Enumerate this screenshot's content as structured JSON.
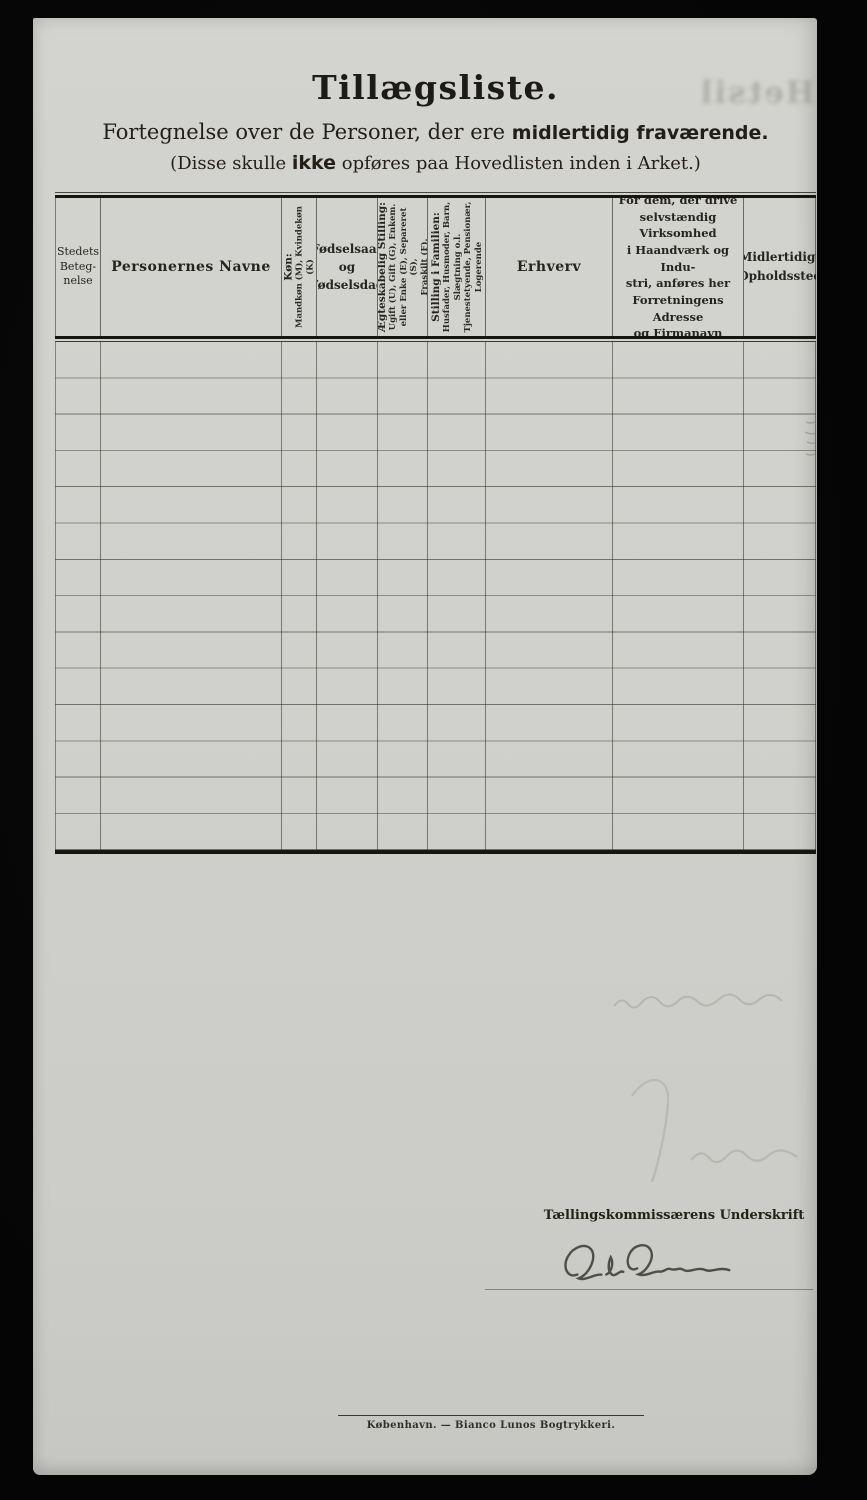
{
  "page": {
    "title": "Tillægsliste.",
    "subtitle_prefix": "Fortegnelse over de Personer, der ere ",
    "subtitle_bold": "midlertidig fraværende.",
    "note_prefix": "(Disse skulle ",
    "note_bold": "ikke",
    "note_suffix": " opføres paa Hovedlisten inden i Arket.)",
    "ghost_text": "Hetsil"
  },
  "table": {
    "columns": [
      {
        "label": "Stedets\nBeteg-\nnelse"
      },
      {
        "label": "Personernes Navne"
      },
      {
        "heading": "Køn:",
        "detail": "Mandkøn (M), Kvindekøn (K)"
      },
      {
        "label": "Fødselsaar\nog\nFødselsdag"
      },
      {
        "heading": "Ægteskabelig Stilling:",
        "detail": "Ugift (U), Gift (G), Enkem.\neller Enke (E), Separeret (S),\nFraskilt (F)."
      },
      {
        "heading": "Stilling i Familien:",
        "detail": "Husfader, Husmoder, Barn,\nSlægtning o.l.\nTjenestetyende, Pensionær,\nLogerende"
      },
      {
        "label": "Erhverv"
      },
      {
        "label": "For dem, der drive\nselvstændig Virksomhed\ni Haandværk og Indu-\nstri, anføres her\nForretningens Adresse\nog Firmanavn"
      },
      {
        "label": "Midlertidigt\nOpholdssted"
      }
    ],
    "body_row_count": "14"
  },
  "signature": {
    "label": "Tællingskommissærens Underskrift",
    "name": "Ole Olsen"
  },
  "footer": {
    "imprint": "København. — Bianco Lunos Bogtrykkeri."
  }
}
